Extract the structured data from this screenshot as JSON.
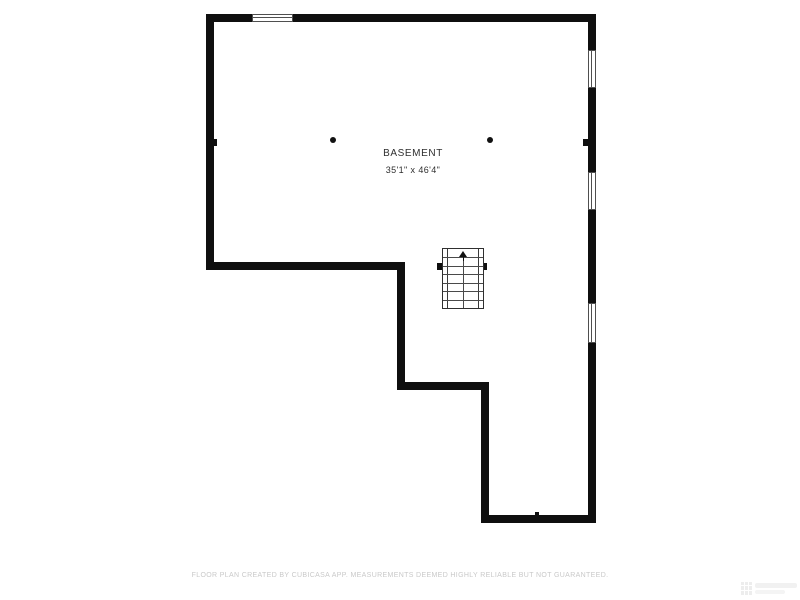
{
  "floor_plan": {
    "room_label": "BASEMENT",
    "room_dimensions": "35'1\" x 46'4\"",
    "footer_disclaimer": "FLOOR PLAN CREATED BY CUBICASA APP. MEASUREMENTS DEEMED HIGHLY RELIABLE BUT NOT GUARANTEED.",
    "stair_direction": "up",
    "colors": {
      "wall": "#0f0f0f",
      "background": "#ffffff",
      "label_text": "#2e2e2e",
      "footer_text": "#c9c9c9",
      "window_frame": "#4f4f4f"
    },
    "geometry": {
      "walls": [
        {
          "name": "top-wall",
          "x": 206,
          "y": 14,
          "w": 390,
          "h": 8
        },
        {
          "name": "left-wall",
          "x": 206,
          "y": 14,
          "w": 8,
          "h": 256
        },
        {
          "name": "right-wall",
          "x": 588,
          "y": 14,
          "w": 8,
          "h": 509
        },
        {
          "name": "mid-horizontal-wall",
          "x": 206,
          "y": 262,
          "w": 199,
          "h": 8
        },
        {
          "name": "mid-vertical-wall",
          "x": 397,
          "y": 262,
          "w": 8,
          "h": 128
        },
        {
          "name": "step-horizontal-wall",
          "x": 397,
          "y": 382,
          "w": 92,
          "h": 8
        },
        {
          "name": "lower-vertical-wall",
          "x": 481,
          "y": 382,
          "w": 8,
          "h": 141
        },
        {
          "name": "bottom-wall",
          "x": 481,
          "y": 515,
          "w": 115,
          "h": 8
        }
      ],
      "windows": [
        {
          "name": "window-top",
          "orient": "h",
          "x": 252,
          "y": 14,
          "w": 41,
          "h": 8
        },
        {
          "name": "window-right-1",
          "orient": "v",
          "x": 588,
          "y": 50,
          "w": 8,
          "h": 38
        },
        {
          "name": "window-right-2",
          "orient": "v",
          "x": 588,
          "y": 172,
          "w": 8,
          "h": 38
        },
        {
          "name": "window-right-3",
          "orient": "v",
          "x": 588,
          "y": 303,
          "w": 8,
          "h": 40
        }
      ],
      "posts": [
        {
          "name": "left-wall-post",
          "x": 212,
          "y": 139,
          "w": 5,
          "h": 7
        },
        {
          "name": "right-wall-post",
          "x": 583,
          "y": 139,
          "w": 6,
          "h": 7
        },
        {
          "name": "stair-left-post",
          "x": 437,
          "y": 263,
          "w": 6,
          "h": 7
        },
        {
          "name": "stair-right-post",
          "x": 481,
          "y": 263,
          "w": 6,
          "h": 7
        },
        {
          "name": "bottom-wall-post",
          "x": 535,
          "y": 512,
          "w": 4,
          "h": 4
        }
      ],
      "columns": [
        {
          "name": "support-column-left",
          "cx": 333,
          "cy": 140,
          "r": 3
        },
        {
          "name": "support-column-right",
          "cx": 490,
          "cy": 140,
          "r": 3
        }
      ],
      "stairs": {
        "x": 442,
        "y": 248,
        "w": 42,
        "h": 61,
        "rows": 7,
        "rail_inset": 4
      }
    }
  }
}
